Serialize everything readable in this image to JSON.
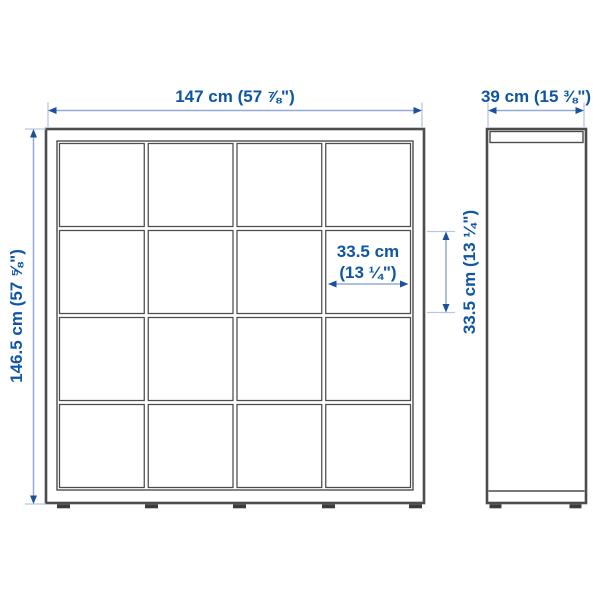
{
  "diagram": {
    "front_view": {
      "width_label": "147 cm (57 ⅞\")",
      "height_label": "146.5 cm (57 ⅝\")",
      "grid_rows": 4,
      "grid_cols": 4
    },
    "compartment": {
      "width_label_line1": "33.5 cm",
      "width_label_line2": "(13 ¼\")",
      "height_label": "33.5 cm (13 ¼\")"
    },
    "side_view": {
      "depth_label": "39 cm (15 ⅜\")"
    },
    "colors": {
      "dimension_text": "#0e55a4",
      "dimension_line": "#93abd5",
      "dimension_arrow": "#1d4f9b",
      "extension_line": "#b7c7e4",
      "furniture_outline": "#4c4c4c",
      "background": "#ffffff"
    }
  }
}
